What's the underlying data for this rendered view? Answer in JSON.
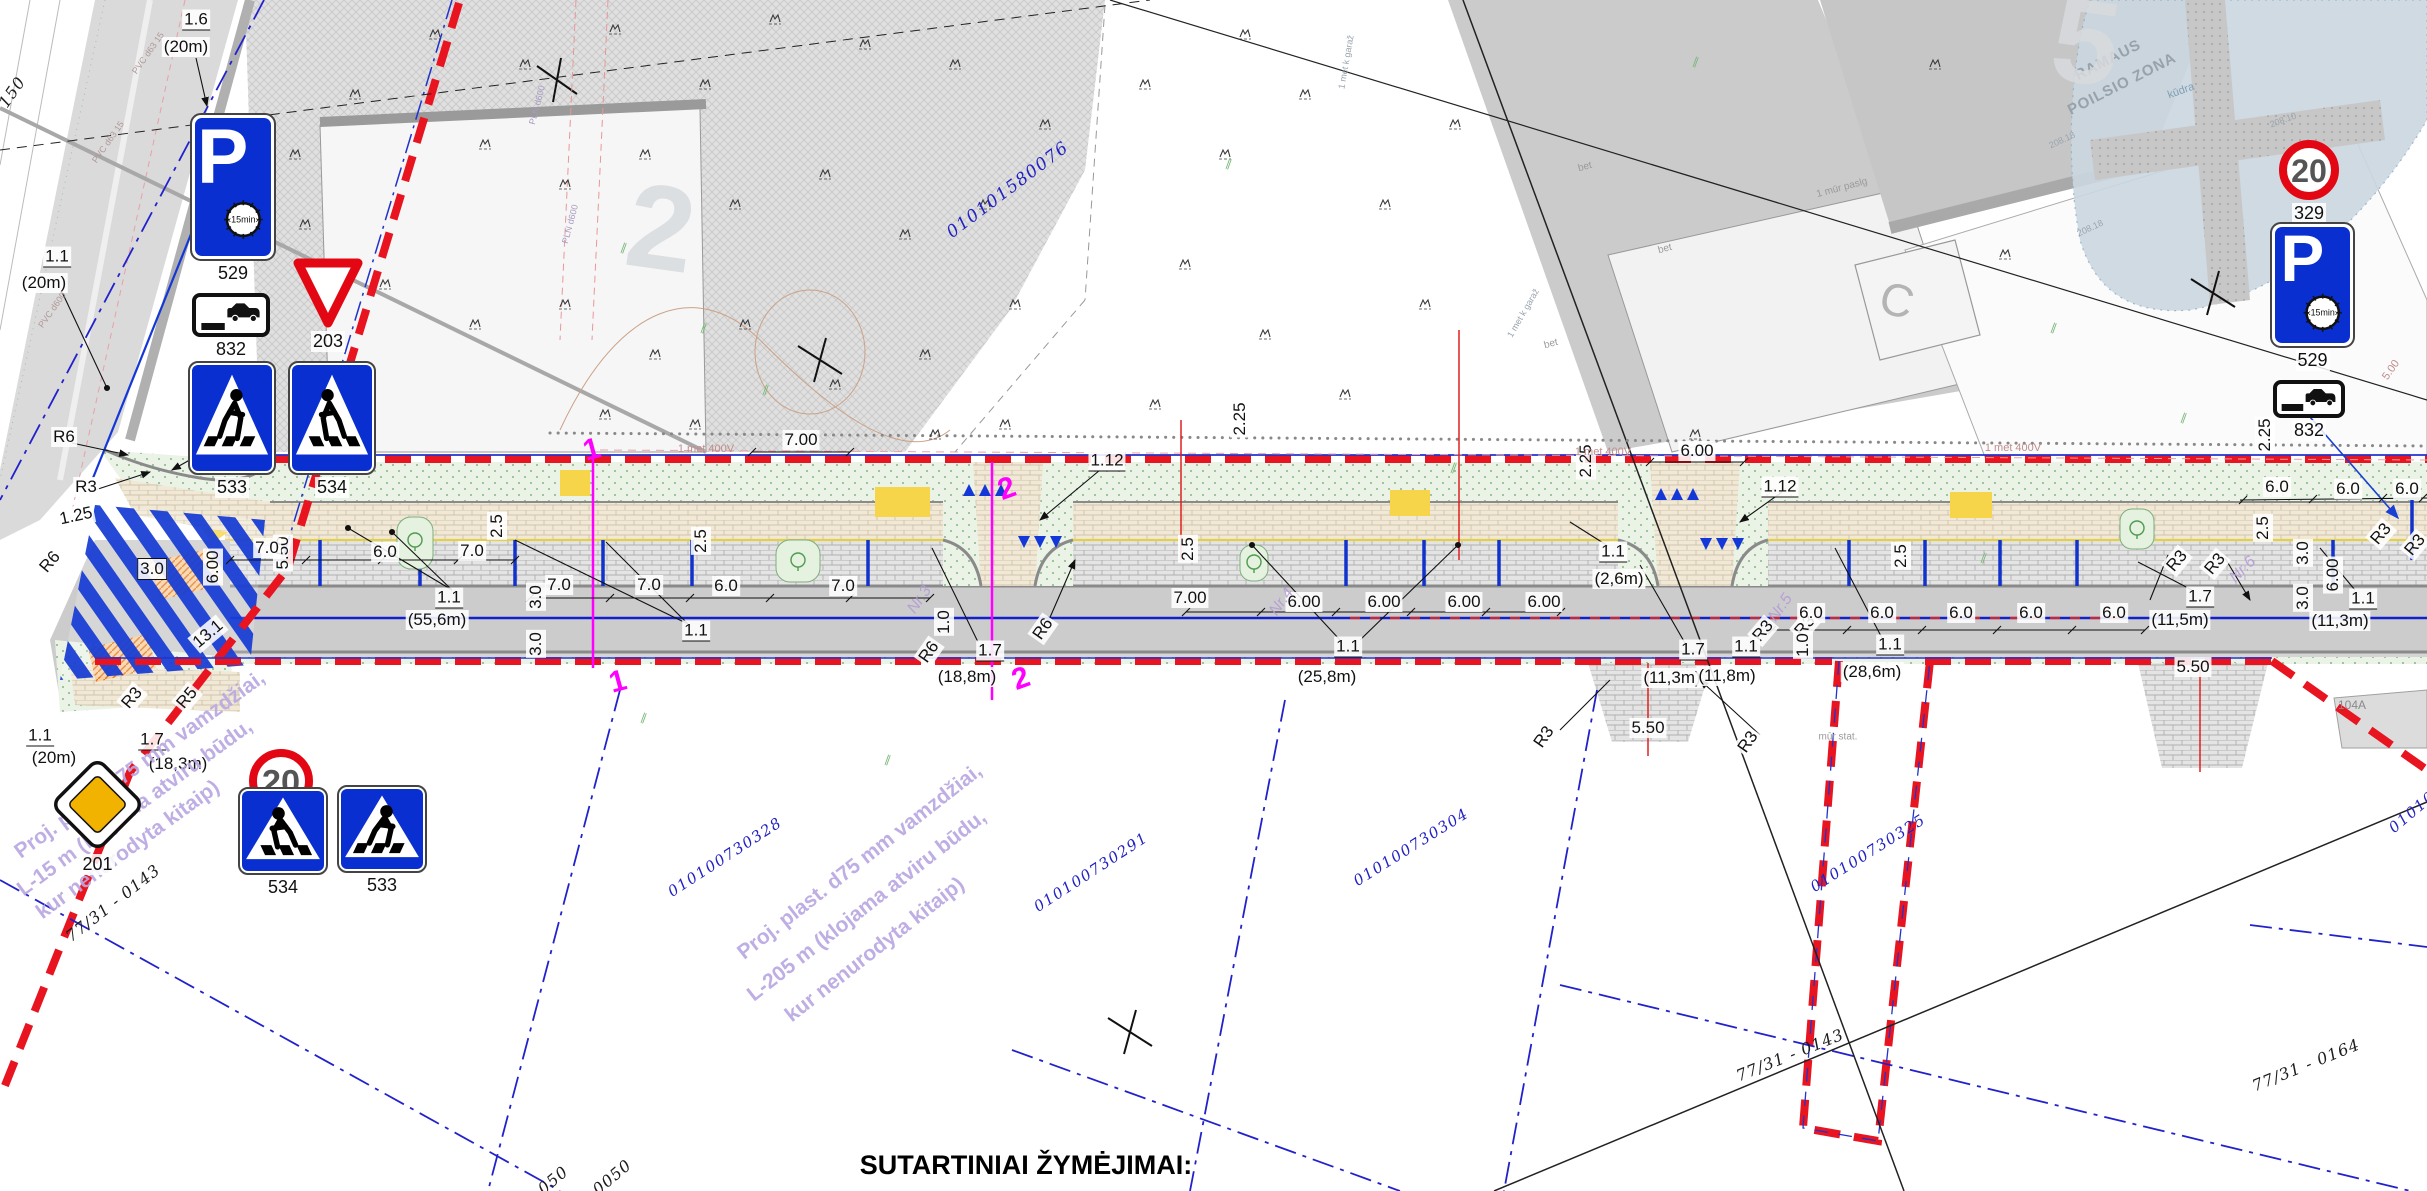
{
  "page": {
    "footer_title": "SUTARTINIAI ŽYMĖJIMAI:"
  },
  "colors": {
    "boundary_red": "#e81420",
    "line_blue": "#2233cc",
    "sign_blue": "#0a2fd0",
    "section_magenta": "#ff00ff",
    "marking_yellow": "#f7d54a",
    "watermark_violet": "#b9a8e2"
  },
  "signs": [
    {
      "kind": "parking",
      "code": "529",
      "clock_text": "15min",
      "x": 190,
      "y": 113,
      "w": 86,
      "h": 148
    },
    {
      "kind": "carplate",
      "code": "832",
      "x": 192,
      "y": 293,
      "w": 78,
      "h": 44
    },
    {
      "kind": "yield",
      "code": "203",
      "x": 292,
      "y": 255,
      "w": 72,
      "h": 74
    },
    {
      "kind": "cross",
      "code": "533",
      "flip": false,
      "x": 188,
      "y": 361,
      "w": 88,
      "h": 114
    },
    {
      "kind": "cross",
      "code": "534",
      "flip": true,
      "x": 288,
      "y": 361,
      "w": 88,
      "h": 114
    },
    {
      "kind": "priority",
      "code": "201",
      "x": 50,
      "y": 757,
      "w": 95,
      "h": 95
    },
    {
      "kind": "speed",
      "code": "329",
      "speed": "20",
      "x": 248,
      "y": 748,
      "w": 66,
      "h": 66
    },
    {
      "kind": "cross",
      "code": "534",
      "flip": true,
      "x": 238,
      "y": 787,
      "w": 90,
      "h": 88
    },
    {
      "kind": "cross",
      "code": "533",
      "flip": false,
      "x": 337,
      "y": 785,
      "w": 90,
      "h": 88
    },
    {
      "kind": "speed",
      "code": "329",
      "speed": "20",
      "x": 2278,
      "y": 139,
      "w": 62,
      "h": 62
    },
    {
      "kind": "parking",
      "code": "529",
      "clock_text": "15min",
      "x": 2270,
      "y": 222,
      "w": 85,
      "h": 126
    },
    {
      "kind": "carplate",
      "code": "832",
      "x": 2273,
      "y": 380,
      "w": 72,
      "h": 38
    }
  ],
  "annotations": [
    {
      "t": "1.6",
      "x": 196,
      "y": 20,
      "u": 1
    },
    {
      "t": "(20m)",
      "x": 186,
      "y": 47
    },
    {
      "t": "1.1",
      "x": 57,
      "y": 257,
      "u": 1
    },
    {
      "t": "(20m)",
      "x": 44,
      "y": 283
    },
    {
      "t": "2.25",
      "x": 343,
      "y": 442,
      "r": -90
    },
    {
      "t": "R6",
      "x": 64,
      "y": 437
    },
    {
      "t": "R3",
      "x": 86,
      "y": 487
    },
    {
      "t": "R1",
      "x": 233,
      "y": 431,
      "r": -50
    },
    {
      "t": "1.25",
      "x": 76,
      "y": 516,
      "r": -12
    },
    {
      "t": "R6",
      "x": 50,
      "y": 562,
      "r": -50
    },
    {
      "t": "3.0",
      "x": 152,
      "y": 569,
      "box": 1
    },
    {
      "t": "6.00",
      "x": 213,
      "y": 567,
      "r": -90
    },
    {
      "t": "5.50",
      "x": 283,
      "y": 553,
      "r": -90
    },
    {
      "t": "13.1",
      "x": 208,
      "y": 634,
      "r": -40
    },
    {
      "t": "R3",
      "x": 132,
      "y": 698,
      "r": -50
    },
    {
      "t": "R5",
      "x": 187,
      "y": 698,
      "r": -50
    },
    {
      "t": "1.1",
      "x": 40,
      "y": 736,
      "u": 1
    },
    {
      "t": "(20m)",
      "x": 54,
      "y": 758
    },
    {
      "t": "1.7",
      "x": 152,
      "y": 740,
      "u": 1
    },
    {
      "t": "(18,3m)",
      "x": 178,
      "y": 764
    },
    {
      "t": "7.0",
      "x": 267,
      "y": 548
    },
    {
      "t": "6.0",
      "x": 385,
      "y": 552
    },
    {
      "t": "7.0",
      "x": 472,
      "y": 551
    },
    {
      "t": "2.5",
      "x": 497,
      "y": 526,
      "r": -90
    },
    {
      "t": "7.0",
      "x": 559,
      "y": 585
    },
    {
      "t": "7.0",
      "x": 649,
      "y": 585
    },
    {
      "t": "2.5",
      "x": 701,
      "y": 541,
      "r": -90
    },
    {
      "t": "6.0",
      "x": 726,
      "y": 586
    },
    {
      "t": "7.0",
      "x": 843,
      "y": 586
    },
    {
      "t": "3.0",
      "x": 536,
      "y": 597,
      "r": -90
    },
    {
      "t": "3.0",
      "x": 536,
      "y": 644,
      "r": -90
    },
    {
      "t": "1.1",
      "x": 449,
      "y": 598,
      "u": 1
    },
    {
      "t": "(55,6m)",
      "x": 437,
      "y": 620
    },
    {
      "t": "1.1",
      "x": 696,
      "y": 631,
      "u": 1
    },
    {
      "t": "7.00",
      "x": 801,
      "y": 440
    },
    {
      "t": "1.12",
      "x": 1107,
      "y": 461,
      "u": 1
    },
    {
      "t": "7.00",
      "x": 1190,
      "y": 598
    },
    {
      "t": "6.00",
      "x": 1304,
      "y": 602
    },
    {
      "t": "6.00",
      "x": 1384,
      "y": 602
    },
    {
      "t": "6.00",
      "x": 1464,
      "y": 602
    },
    {
      "t": "6.00",
      "x": 1544,
      "y": 602
    },
    {
      "t": "1.0",
      "x": 944,
      "y": 622,
      "r": -90
    },
    {
      "t": "R6",
      "x": 929,
      "y": 652,
      "r": -55
    },
    {
      "t": "R6",
      "x": 1043,
      "y": 629,
      "r": -55
    },
    {
      "t": "1.7",
      "x": 990,
      "y": 651,
      "u": 1
    },
    {
      "t": "(18,8m)",
      "x": 967,
      "y": 677
    },
    {
      "t": "2.25",
      "x": 1240,
      "y": 419,
      "r": -90
    },
    {
      "t": "2.5",
      "x": 1188,
      "y": 549,
      "r": -90
    },
    {
      "t": "1.1",
      "x": 1348,
      "y": 647,
      "u": 1
    },
    {
      "t": "(25,8m)",
      "x": 1327,
      "y": 677
    },
    {
      "t": "1.1",
      "x": 1613,
      "y": 552,
      "u": 1
    },
    {
      "t": "(2,6m)",
      "x": 1619,
      "y": 579
    },
    {
      "t": "2.25",
      "x": 1586,
      "y": 461,
      "r": -90
    },
    {
      "t": "6.00",
      "x": 1697,
      "y": 451
    },
    {
      "t": "1.12",
      "x": 1780,
      "y": 487,
      "u": 1
    },
    {
      "t": "1.7",
      "x": 1693,
      "y": 650,
      "u": 1
    },
    {
      "t": "(11,3m)",
      "x": 1672,
      "y": 678
    },
    {
      "t": "5.50",
      "x": 1648,
      "y": 728
    },
    {
      "t": "R3",
      "x": 1544,
      "y": 737,
      "r": -55
    },
    {
      "t": "R3",
      "x": 1748,
      "y": 742,
      "r": -55
    },
    {
      "t": "R3",
      "x": 1763,
      "y": 631,
      "r": -50
    },
    {
      "t": "R3",
      "x": 1805,
      "y": 626,
      "r": -50
    },
    {
      "t": "1.1",
      "x": 1746,
      "y": 647,
      "u": 1
    },
    {
      "t": "(11,8m)",
      "x": 1727,
      "y": 676
    },
    {
      "t": "2.5",
      "x": 1901,
      "y": 556,
      "r": -90
    },
    {
      "t": "1.0",
      "x": 1803,
      "y": 645,
      "r": -90
    },
    {
      "t": "1.1",
      "x": 1890,
      "y": 645,
      "u": 1
    },
    {
      "t": "(28,6m)",
      "x": 1872,
      "y": 672
    },
    {
      "t": "6.0",
      "x": 1811,
      "y": 613
    },
    {
      "t": "6.0",
      "x": 1882,
      "y": 613
    },
    {
      "t": "6.0",
      "x": 1961,
      "y": 613
    },
    {
      "t": "6.0",
      "x": 2031,
      "y": 613
    },
    {
      "t": "6.0",
      "x": 2114,
      "y": 613
    },
    {
      "t": "6.0",
      "x": 2277,
      "y": 487
    },
    {
      "t": "6.0",
      "x": 2348,
      "y": 489
    },
    {
      "t": "6.0",
      "x": 2407,
      "y": 489
    },
    {
      "t": "2.25",
      "x": 2265,
      "y": 435,
      "r": -90
    },
    {
      "t": "2.5",
      "x": 2263,
      "y": 528,
      "r": -90
    },
    {
      "t": "R3",
      "x": 2177,
      "y": 561,
      "r": -50
    },
    {
      "t": "R3",
      "x": 2215,
      "y": 564,
      "r": -50
    },
    {
      "t": "R3",
      "x": 2381,
      "y": 534,
      "r": -50
    },
    {
      "t": "R3",
      "x": 2415,
      "y": 545,
      "r": -50
    },
    {
      "t": "1.7",
      "x": 2200,
      "y": 597,
      "u": 1
    },
    {
      "t": "(11,5m)",
      "x": 2180,
      "y": 620
    },
    {
      "t": "5.50",
      "x": 2193,
      "y": 667
    },
    {
      "t": "3.0",
      "x": 2303,
      "y": 553,
      "r": -90
    },
    {
      "t": "3.0",
      "x": 2303,
      "y": 598,
      "r": -90
    },
    {
      "t": "6.00",
      "x": 2333,
      "y": 575,
      "r": -90
    },
    {
      "t": "1.1",
      "x": 2363,
      "y": 599,
      "u": 1
    },
    {
      "t": "(11,3m)",
      "x": 2340,
      "y": 621
    },
    {
      "t": "1",
      "x": 592,
      "y": 450,
      "r": -15,
      "c": "mg"
    },
    {
      "t": "1",
      "x": 618,
      "y": 682,
      "r": -15,
      "c": "mg"
    },
    {
      "t": "2",
      "x": 1007,
      "y": 489,
      "r": -20,
      "c": "mg"
    },
    {
      "t": "2",
      "x": 1021,
      "y": 679,
      "r": -20,
      "c": "mg"
    },
    {
      "t": "010100730328",
      "x": 725,
      "y": 857,
      "r": -33,
      "c": "cad"
    },
    {
      "t": "010100730291",
      "x": 1091,
      "y": 872,
      "r": -33,
      "c": "cad"
    },
    {
      "t": "010100730304",
      "x": 1411,
      "y": 847,
      "r": -32,
      "c": "cad"
    },
    {
      "t": "010100730325",
      "x": 1868,
      "y": 853,
      "r": -32,
      "c": "cad"
    },
    {
      "t": "01010",
      "x": 2412,
      "y": 812,
      "r": -40,
      "c": "cad"
    },
    {
      "t": "010101580076",
      "x": 1008,
      "y": 190,
      "r": -37,
      "c": "cadL"
    },
    {
      "t": "77/31 - 0143",
      "x": 113,
      "y": 903,
      "r": -38,
      "c": "par"
    },
    {
      "t": "77/31 - 0143",
      "x": 1790,
      "y": 1055,
      "r": -22,
      "c": "par"
    },
    {
      "t": "77/31 - 0164",
      "x": 2306,
      "y": 1065,
      "r": -22,
      "c": "par"
    },
    {
      "t": "050",
      "x": 553,
      "y": 1180,
      "r": -40,
      "c": "par"
    },
    {
      "t": "0050",
      "x": 612,
      "y": 1177,
      "r": -40,
      "c": "par"
    },
    {
      "t": "150",
      "x": 12,
      "y": 92,
      "r": -55,
      "c": "par"
    },
    {
      "t": "Proj. plast. d75 mm vamzdžiai,",
      "x": 140,
      "y": 765,
      "r": -36,
      "c": "wm"
    },
    {
      "t": "L-15 m (klojama atviru būdu,",
      "x": 135,
      "y": 808,
      "r": -36,
      "c": "wm"
    },
    {
      "t": "kur nenurodyta kitaip)",
      "x": 128,
      "y": 850,
      "r": -36,
      "c": "wm"
    },
    {
      "t": "Proj. plast. d75 mm vamzdžiai,",
      "x": 860,
      "y": 862,
      "r": -38,
      "c": "wm"
    },
    {
      "t": "L-205 m (klojama atviru būdu,",
      "x": 867,
      "y": 906,
      "r": -38,
      "c": "wm"
    },
    {
      "t": "kur nenurodyta kitaip)",
      "x": 875,
      "y": 950,
      "r": -38,
      "c": "wm"
    },
    {
      "t": "RAMAUS",
      "x": 2108,
      "y": 60,
      "r": -27,
      "c": "g15"
    },
    {
      "t": "POILSIO ZONA",
      "x": 2122,
      "y": 84,
      "r": -27,
      "c": "g15"
    },
    {
      "t": "kūdra",
      "x": 2181,
      "y": 91,
      "r": -20,
      "c": "g11b"
    },
    {
      "t": "208.10",
      "x": 2283,
      "y": 120,
      "r": -20,
      "c": "g9"
    },
    {
      "t": "208.18",
      "x": 2062,
      "y": 140,
      "r": -25,
      "c": "g9"
    },
    {
      "t": "208.18",
      "x": 2090,
      "y": 228,
      "r": -25,
      "c": "g9"
    },
    {
      "t": "C",
      "x": 1897,
      "y": 300,
      "r": 15,
      "c": "gC"
    },
    {
      "t": "2",
      "x": 661,
      "y": 228,
      "r": 8,
      "c": "gW"
    },
    {
      "t": "5",
      "x": 2086,
      "y": 42,
      "r": 8,
      "c": "gW"
    },
    {
      "t": "bet",
      "x": 1585,
      "y": 167,
      "r": -15,
      "c": "g10"
    },
    {
      "t": "bet",
      "x": 1665,
      "y": 249,
      "r": -15,
      "c": "g10"
    },
    {
      "t": "bet",
      "x": 1551,
      "y": 344,
      "r": -15,
      "c": "g10"
    },
    {
      "t": "1 mūr paslg",
      "x": 1842,
      "y": 188,
      "r": -15,
      "c": "g10"
    },
    {
      "t": "mūr stat.",
      "x": 1838,
      "y": 737,
      "c": "g10"
    },
    {
      "t": "1 met k garaž",
      "x": 1346,
      "y": 62,
      "r": -80,
      "c": "g9"
    },
    {
      "t": "1 met k garaž",
      "x": 1523,
      "y": 313,
      "r": -60,
      "c": "g9"
    },
    {
      "t": "104A",
      "x": 2352,
      "y": 705,
      "c": "g11"
    },
    {
      "t": "1 met 400V",
      "x": 706,
      "y": 449,
      "c": "pk"
    },
    {
      "t": "1 met 400V",
      "x": 1603,
      "y": 452,
      "c": "pk"
    },
    {
      "t": "1 met 400V",
      "x": 2013,
      "y": 448,
      "c": "pk"
    },
    {
      "t": "5.00",
      "x": 2391,
      "y": 370,
      "r": -55,
      "c": "pk"
    },
    {
      "t": "PVC d63 15",
      "x": 148,
      "y": 53,
      "r": -55,
      "c": "t9"
    },
    {
      "t": "PVC d63 15",
      "x": 108,
      "y": 142,
      "r": -55,
      "c": "t9"
    },
    {
      "t": "PVC d600",
      "x": 52,
      "y": 310,
      "r": -55,
      "c": "t9"
    },
    {
      "t": "PLN d600",
      "x": 537,
      "y": 105,
      "r": -75,
      "c": "t9v"
    },
    {
      "t": "PLN d600",
      "x": 570,
      "y": 224,
      "r": -75,
      "c": "t9v"
    },
    {
      "t": "Nr.3",
      "x": 920,
      "y": 600,
      "r": -55,
      "c": "nr"
    },
    {
      "t": "Nr.4",
      "x": 1282,
      "y": 602,
      "r": -55,
      "c": "nr"
    },
    {
      "t": "Nr.5",
      "x": 1781,
      "y": 608,
      "r": -55,
      "c": "nr"
    },
    {
      "t": "Nr.6",
      "x": 2243,
      "y": 570,
      "r": -45,
      "c": "nr"
    }
  ],
  "bushes": [
    [
      430,
      30
    ],
    [
      520,
      60
    ],
    [
      610,
      25
    ],
    [
      700,
      80
    ],
    [
      480,
      140
    ],
    [
      560,
      180
    ],
    [
      640,
      150
    ],
    [
      730,
      200
    ],
    [
      820,
      170
    ],
    [
      900,
      230
    ],
    [
      980,
      200
    ],
    [
      300,
      220
    ],
    [
      380,
      280
    ],
    [
      470,
      320
    ],
    [
      560,
      300
    ],
    [
      650,
      350
    ],
    [
      740,
      320
    ],
    [
      830,
      380
    ],
    [
      920,
      350
    ],
    [
      1010,
      300
    ],
    [
      1040,
      120
    ],
    [
      950,
      60
    ],
    [
      860,
      40
    ],
    [
      770,
      15
    ],
    [
      350,
      90
    ],
    [
      290,
      150
    ],
    [
      1000,
      420
    ],
    [
      930,
      430
    ],
    [
      690,
      420
    ],
    [
      600,
      410
    ],
    [
      1140,
      80
    ],
    [
      1220,
      150
    ],
    [
      1300,
      90
    ],
    [
      1380,
      200
    ],
    [
      1180,
      260
    ],
    [
      1260,
      330
    ],
    [
      1340,
      390
    ],
    [
      1420,
      300
    ],
    [
      1150,
      400
    ],
    [
      1450,
      120
    ],
    [
      1690,
      430
    ],
    [
      1930,
      60
    ],
    [
      2000,
      250
    ],
    [
      1240,
      30
    ]
  ],
  "veg_marks": [
    [
      700,
      330
    ],
    [
      762,
      392
    ],
    [
      640,
      720
    ],
    [
      884,
      762
    ],
    [
      1692,
      64
    ],
    [
      1225,
      166
    ],
    [
      2050,
      330
    ],
    [
      2180,
      420
    ],
    [
      1980,
      560
    ],
    [
      1450,
      470
    ],
    [
      2340,
      320
    ],
    [
      620,
      250
    ]
  ]
}
